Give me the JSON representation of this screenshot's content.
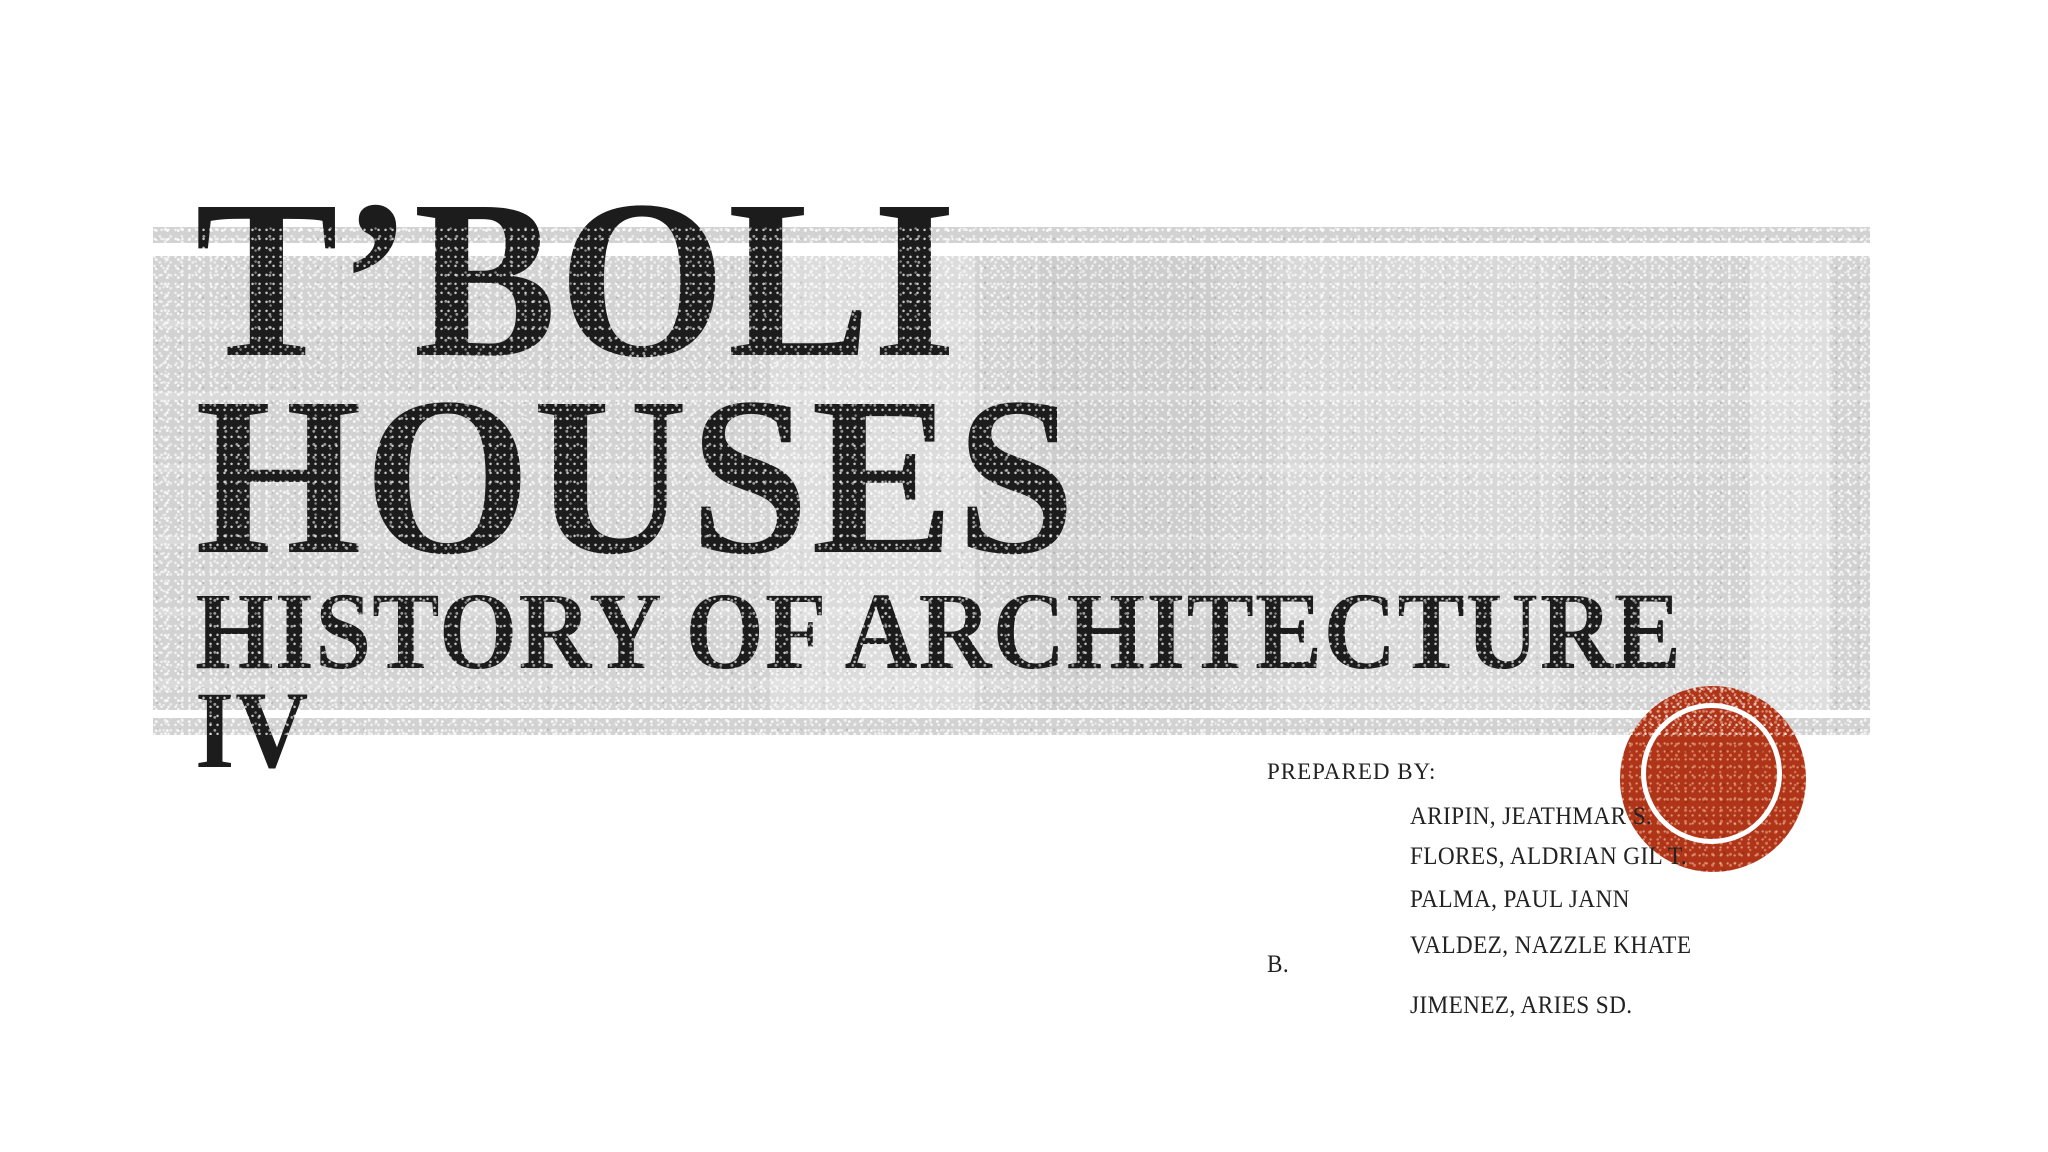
{
  "slide": {
    "title_lines": [
      "T’BOLI",
      "HOUSES"
    ],
    "subtitle_lines": [
      "HISTORY OF ARCHITECTURE",
      "IV"
    ],
    "prepared_by": {
      "label": "PREPARED BY:",
      "name_lines": [
        "ARIPIN, JEATHMAR S.",
        "FLORES, ALDRIAN GIL T.",
        "PALMA, PAUL JANN",
        "VALDEZ, NAZZLE KHATE",
        "B.",
        "JIMENEZ, ARIES SD."
      ]
    },
    "colors": {
      "background": "#ffffff",
      "band_gray": "#d2d2d2",
      "title_ink": "#1c1c1c",
      "body_ink": "#222222",
      "stamp_red": "#b03418",
      "ring_white": "#ffffff"
    }
  }
}
